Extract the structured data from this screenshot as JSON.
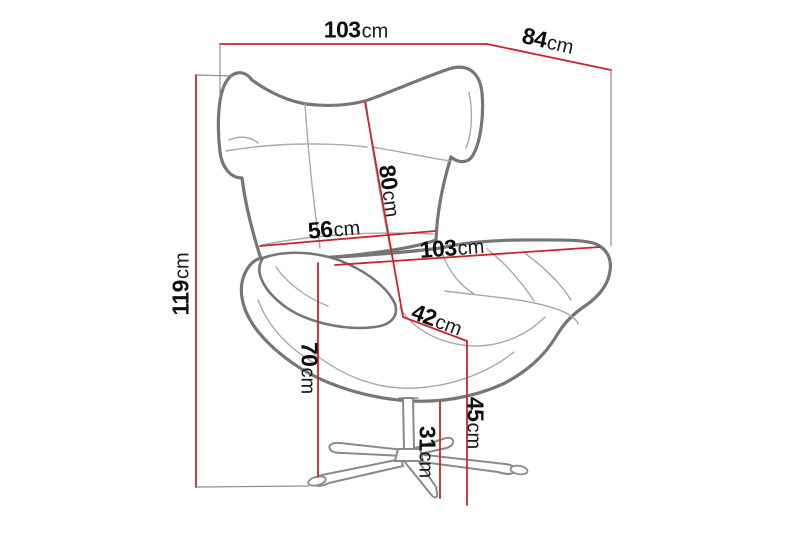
{
  "diagram": {
    "subject": "wing-back egg armchair with swivel star base, dimension drawing",
    "unit": "cm",
    "labels": {
      "top_width": {
        "value": "103",
        "unit": "cm"
      },
      "top_depth": {
        "value": "84",
        "unit": "cm"
      },
      "total_height": {
        "value": "119",
        "unit": "cm"
      },
      "backrest_height": {
        "value": "80",
        "unit": "cm"
      },
      "backrest_width": {
        "value": "56",
        "unit": "cm"
      },
      "overall_width": {
        "value": "103",
        "unit": "cm"
      },
      "seat_depth": {
        "value": "42",
        "unit": "cm"
      },
      "armrest_height": {
        "value": "70",
        "unit": "cm"
      },
      "seat_height": {
        "value": "45",
        "unit": "cm"
      },
      "base_height": {
        "value": "31",
        "unit": "cm"
      }
    },
    "colors": {
      "dimension_line": "#c9252b",
      "chair_outline": "#767676",
      "chair_seam": "#a8a8a8",
      "base_line": "#8a8a8a",
      "projection_line": "#8f8f8f",
      "label_text": "#0e0e0e",
      "background": "#ffffff"
    }
  }
}
